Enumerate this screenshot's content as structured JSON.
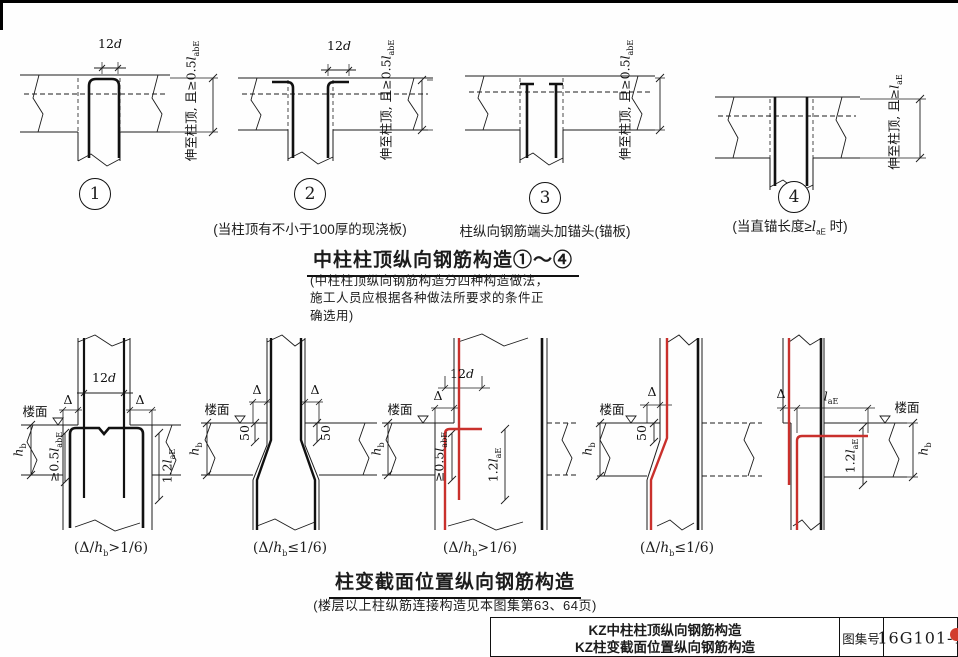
{
  "page": {
    "title1": "中柱柱顶纵向钢筋构造①～④",
    "note1_lines": [
      "(中柱柱顶纵向钢筋构造分四种构造做法，",
      "施工人员应根据各种做法所要求的条件正",
      "确选用)"
    ],
    "title2": "柱变截面位置纵向钢筋构造",
    "note2": "(楼层以上柱纵筋连接构造见本图集第63、64页)"
  },
  "titleblock": {
    "line1": "KZ中柱柱顶纵向钢筋构造",
    "line2": "KZ柱变截面位置纵向钢筋构造",
    "label": "图集号",
    "number": "16G101-1"
  },
  "labels": {
    "twelve_d": {
      "pre": "12",
      "var": "d"
    },
    "delta": "Δ",
    "loumian": "楼面",
    "fifty": "50",
    "hb": {
      "var": "h",
      "sub": "b"
    },
    "ge05labe": {
      "pre": "≥0.5",
      "var": "l",
      "sub": "abE"
    },
    "l12ae": {
      "pre": "1.2",
      "var": "l",
      "sub": "aE"
    },
    "lae": {
      "var": "l",
      "sub": "aE"
    },
    "extend_05labe": {
      "pre": "伸至柱顶, 且≥0.5",
      "var": "l",
      "sub": "abE"
    },
    "extend_lae": {
      "pre": "伸至柱顶, 且≥",
      "var": "l",
      "sub": "aE"
    },
    "cap_gt": {
      "pre": "(Δ/",
      "var": "h",
      "sub": "b",
      "post": ">1/6)"
    },
    "cap_le": {
      "pre": "(Δ/",
      "var": "h",
      "sub": "b",
      "post": "≤1/6)"
    }
  },
  "top_row": {
    "d1": {
      "num": "1"
    },
    "d2": {
      "num": "2",
      "caption": "(当柱顶有不小于100厚的现浇板)"
    },
    "d3": {
      "num": "3",
      "caption": "柱纵向钢筋端头加锚头(锚板)"
    },
    "d4": {
      "num": "4",
      "cap": {
        "pre": "(当直锚长度≥",
        "var": "l",
        "sub": "aE",
        "post": " 时)"
      }
    }
  },
  "colors": {
    "rebar_red": "#c9302c",
    "line": "#1c1c1c"
  }
}
